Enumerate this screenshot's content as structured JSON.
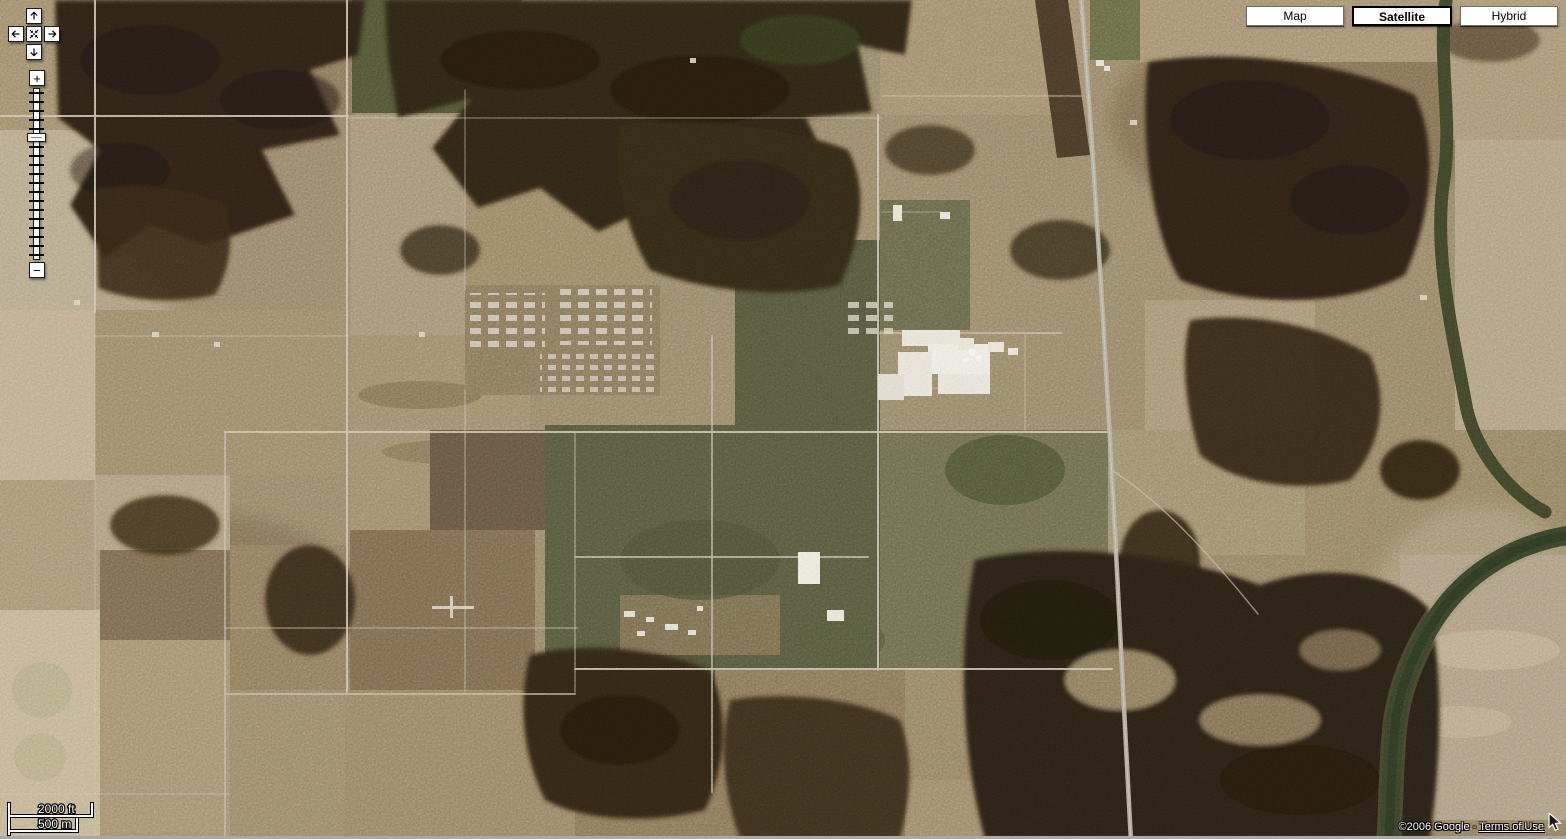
{
  "app": {
    "name": "Google Maps",
    "view": "satellite"
  },
  "map_type_selector": {
    "buttons": [
      {
        "label": "Map",
        "selected": false
      },
      {
        "label": "Satellite",
        "selected": true
      },
      {
        "label": "Hybrid",
        "selected": false
      }
    ]
  },
  "pan_control": {
    "up_icon": "arrow-up",
    "left_icon": "arrow-left",
    "center_icon": "recenter",
    "right_icon": "arrow-right",
    "down_icon": "arrow-down"
  },
  "zoom_control": {
    "zoom_in_label": "+",
    "zoom_out_label": "−",
    "tick_count": 19,
    "thumb_tick_index": 5
  },
  "scale_bar": {
    "imperial_label": "2000 ft",
    "metric_label": "500 m"
  },
  "attribution": {
    "copyright": "©2006 Google",
    "separator": " - ",
    "terms_label": "Terms of Use",
    "cursor": "mouse-arrow-cursor"
  },
  "theme": {
    "control_bg": "#ffffff",
    "control_border": "#1a1a1a",
    "button_border": "#6e6e6e",
    "selected_border": "#000000",
    "control_text": "#000000",
    "outline_text": "#ffffff",
    "window_edge": "#a8a8a8",
    "map_palette": {
      "base_tan": "#9a886a",
      "field_light": "#c2b191",
      "field_gray": "#8a7a66",
      "field_dark": "#675742",
      "woods_dark": "#2e2414",
      "crop_green": "#4a5130",
      "road": "#d4cbb7",
      "highway": "#b6b0a0",
      "river_green": "#38422a",
      "building_white": "#ece8dd",
      "sand": "#b1a084"
    }
  }
}
